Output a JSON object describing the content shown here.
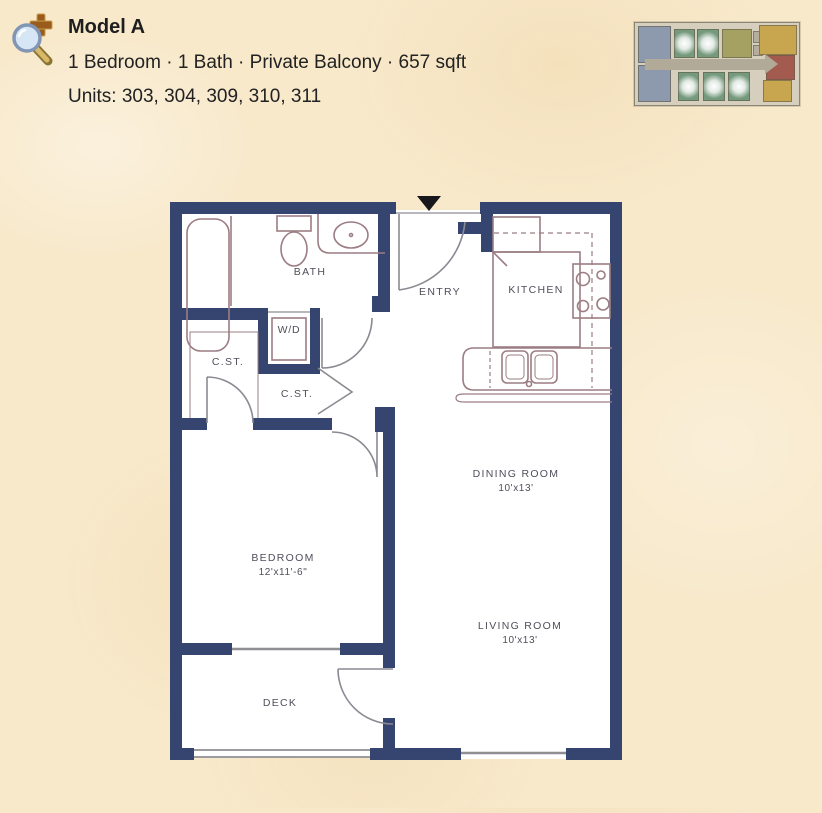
{
  "header": {
    "title": "Model A",
    "details": "1 Bedroom · 1 Bath · Private Balcony · 657 sqft",
    "units": "Units: 303, 304, 309, 310, 311"
  },
  "floorplan": {
    "rooms": {
      "bath": {
        "label": "BATH"
      },
      "wd": {
        "label": "W/D"
      },
      "closet_left": {
        "label": "C.ST."
      },
      "closet_hall": {
        "label": "C.ST."
      },
      "entry": {
        "label": "ENTRY"
      },
      "kitchen": {
        "label": "KITCHEN"
      },
      "dining": {
        "label": "DINING ROOM",
        "dims": "10'x13'"
      },
      "living": {
        "label": "LIVING ROOM",
        "dims": "10'x13'"
      },
      "bedroom": {
        "label": "BEDROOM",
        "dims": "12'x11'-6\""
      },
      "deck": {
        "label": "DECK"
      }
    },
    "colors": {
      "wall": "#36456f",
      "fixture": "#9b7d83",
      "door": "#8a8a92",
      "window": "#8e8e93",
      "entry_marker": "#17171c"
    }
  },
  "thumbnail": {
    "unit_colors": {
      "blue": "#8d9aae",
      "green_highlight": "#74997c",
      "olive": "#a5a162",
      "mustard": "#c7a64f",
      "red": "#a25b4e",
      "corridor": "#b2aa98"
    }
  }
}
